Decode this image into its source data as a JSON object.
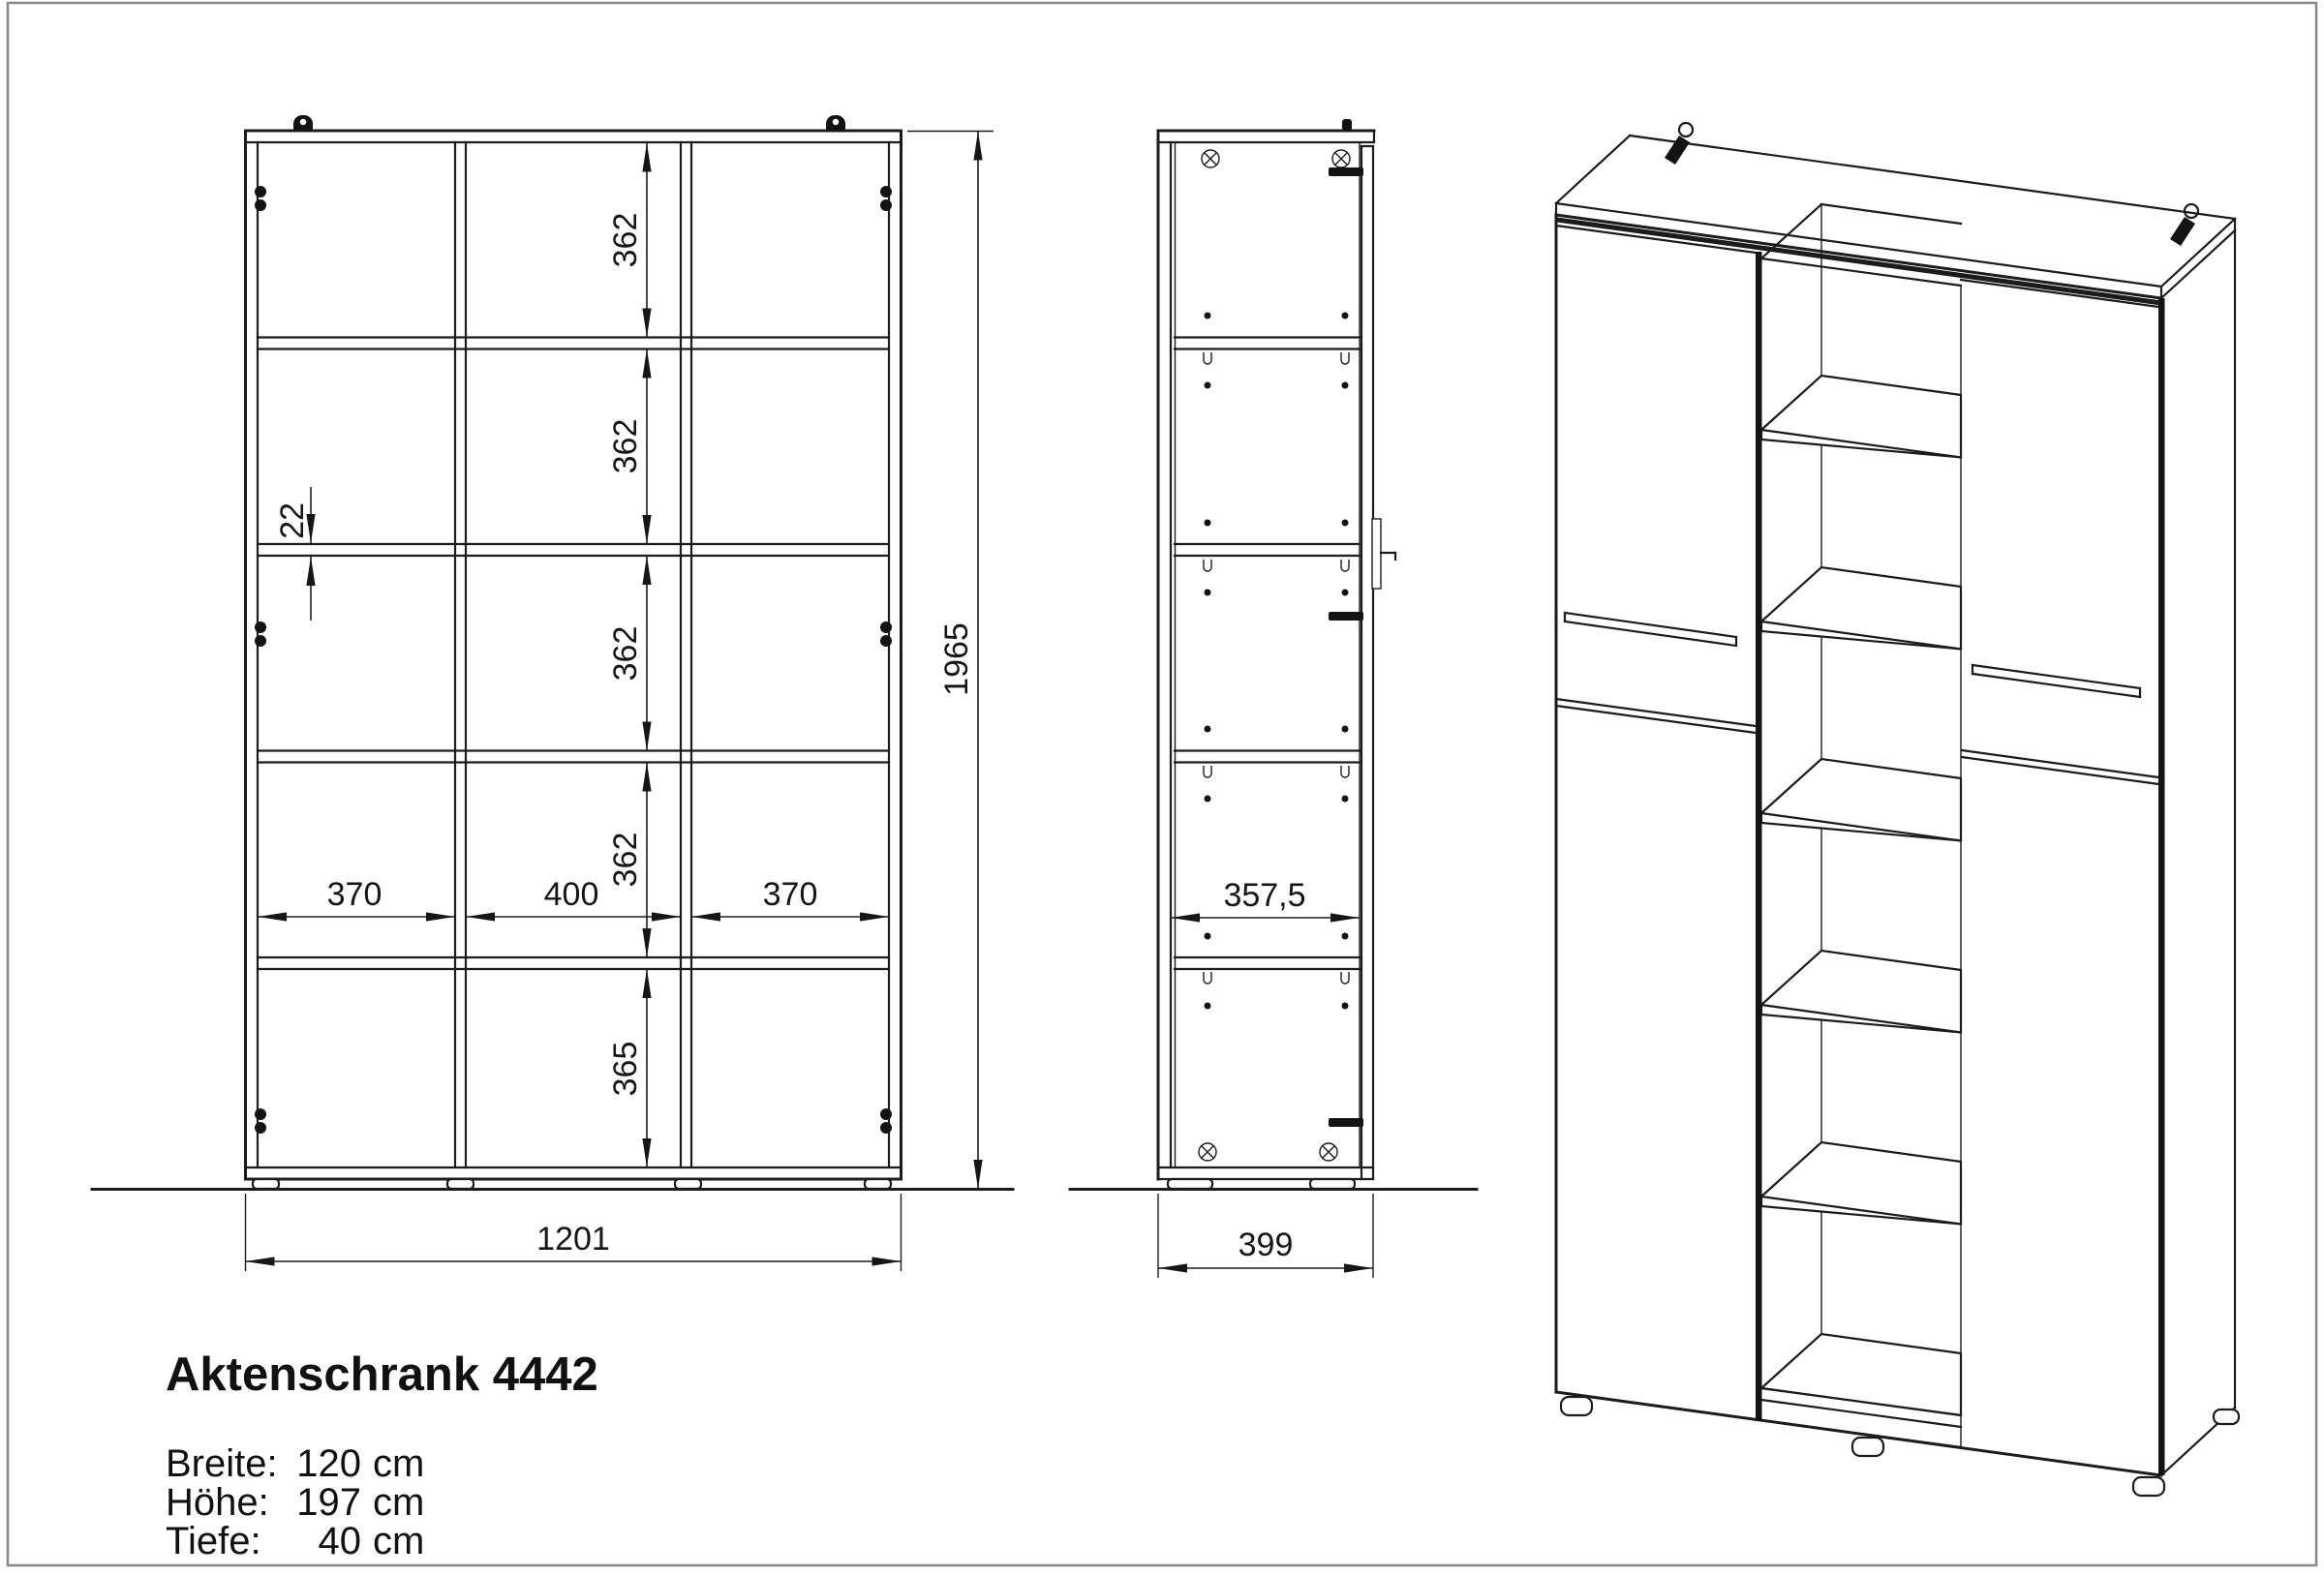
{
  "drawing": {
    "product_title": "Aktenschrank 4442",
    "specs": [
      {
        "label": "Breite:",
        "value": "120",
        "unit": "cm"
      },
      {
        "label": "Höhe:",
        "value": "197",
        "unit": "cm"
      },
      {
        "label": "Tiefe:",
        "value": "40",
        "unit": "cm"
      }
    ]
  },
  "views": {
    "front": {
      "dims": {
        "cell_heights": [
          "362",
          "362",
          "362",
          "362"
        ],
        "bottom_cell_height": "365",
        "panel_thickness": "22",
        "cell_widths": [
          "370",
          "400",
          "370"
        ],
        "overall_width": "1201",
        "overall_height": "1965"
      }
    },
    "side": {
      "dims": {
        "interior_depth": "357,5",
        "overall_depth": "399"
      }
    }
  },
  "colors": {
    "line": "#1a1a1a",
    "accent_black": "#131313",
    "frame_border": "#888888",
    "background": "#ffffff"
  }
}
